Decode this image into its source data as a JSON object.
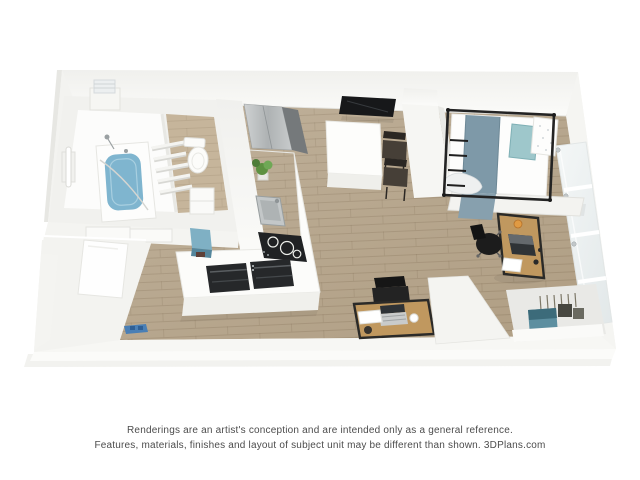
{
  "image": {
    "kind": "3d-floor-plan-rendering",
    "description": "Top-down 3D rendering of a furnished studio apartment unit"
  },
  "caption": {
    "line1": "Renderings are an artist's conception and are intended only as a general reference.",
    "line2": "Features, materials, finishes and layout of subject unit may be different than shown. ",
    "brand": "3DPlans.com"
  },
  "colors": {
    "background": "#ffffff",
    "wall": "#f3f3f0",
    "wall_bright": "#fbfbf9",
    "floor_wood": "#b7a68c",
    "floor_wood_light": "#c6b59b",
    "tub_water": "#7fb5cf",
    "blanket_blue": "#7e99a8",
    "blanket_drape": "#87a0ae",
    "pillow_teal": "#9ec7cb",
    "desk_wood": "#c0985f",
    "appliance_dark": "#202224",
    "tv_black": "#17181a",
    "stainless": "#b7bbbc",
    "glass": "#edf1f1",
    "chair_black": "#1c1c1c",
    "plant_green": "#5d9141",
    "bag_teal": "#5d8fa0",
    "stool_teal": "#7fb0c4",
    "mat_blue": "#4a7fb5",
    "caption_text": "#4c4c4c"
  },
  "depicted": {
    "rooms": [
      "bathroom",
      "kitchen",
      "entry-hall",
      "living-sleeping-area",
      "closet-niche"
    ],
    "furniture": [
      "bathtub",
      "toilet",
      "towel-rack",
      "refrigerator",
      "kitchen-counter",
      "sink",
      "cooktop",
      "kitchen-island",
      "wall-tv",
      "dining-table",
      "dining-chairs",
      "bed-with-blue-blanket",
      "floor-to-ceiling-windows",
      "desk-by-window",
      "office-chair",
      "desk-bottom-wall",
      "laptops",
      "storage-bags",
      "door-mat"
    ]
  }
}
